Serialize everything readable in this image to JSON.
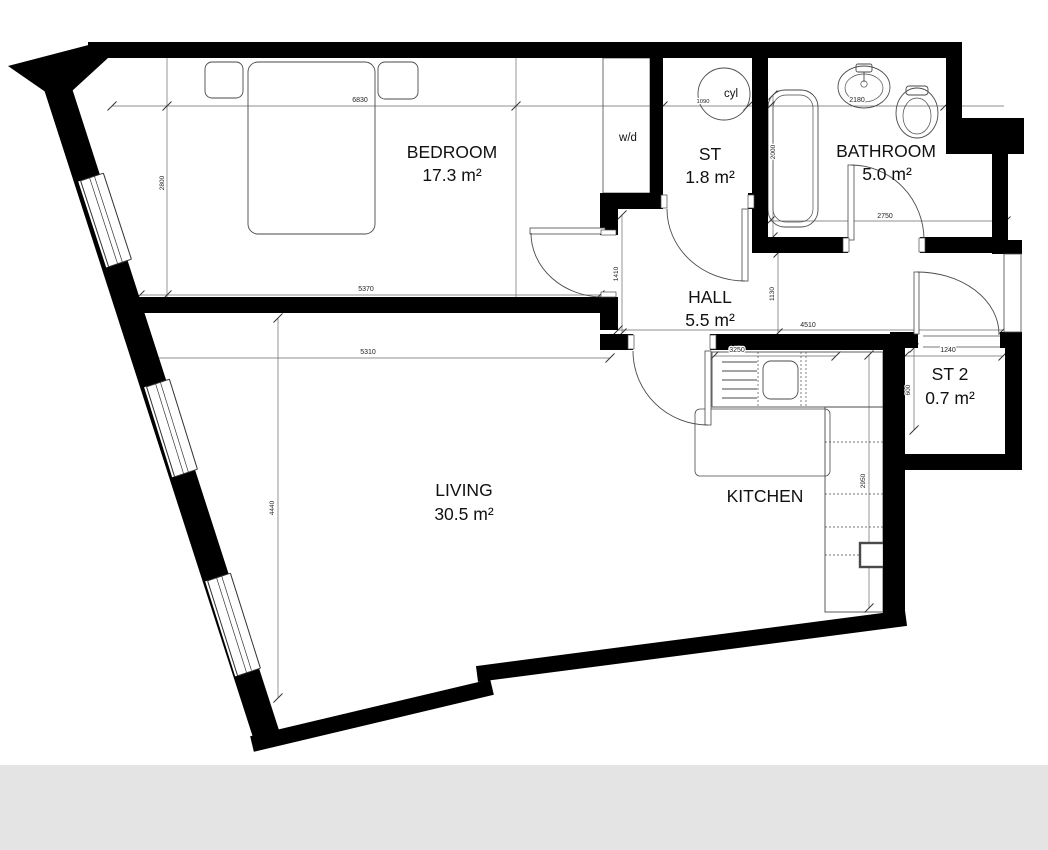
{
  "plan": {
    "title": "one-bedroom apartment floor plan",
    "rooms": {
      "bedroom": {
        "name": "BEDROOM",
        "area": "17.3 m²"
      },
      "st": {
        "name": "ST",
        "area": "1.8 m²"
      },
      "bathroom": {
        "name": "BATHROOM",
        "area": "5.0 m²"
      },
      "hall": {
        "name": "HALL",
        "area": "5.5 m²"
      },
      "st2": {
        "name": "ST 2",
        "area": "0.7 m²"
      },
      "living": {
        "name": "LIVING",
        "area": "30.5 m²"
      },
      "kitchen": {
        "name": "KITCHEN",
        "area": ""
      }
    },
    "fixtures": {
      "washer_dryer": "w/d",
      "cylinder": "cyl"
    },
    "dims": {
      "d6830": "6830",
      "d2800": "2800",
      "d5370": "5370",
      "d5310": "5310",
      "d4440": "4440",
      "d1410": "1410",
      "d1130": "1130",
      "d4510": "4510",
      "d3250": "3250",
      "d2950": "2950",
      "d1240": "1240",
      "d600": "600",
      "d2180": "2180",
      "d2000": "2000",
      "d2750": "2750",
      "d1090": "1090"
    },
    "colors": {
      "wall": "#000000",
      "thin_line": "#4a4a4a",
      "dim_line": "#6a6a6a",
      "footer_band": "#e4e4e4",
      "background": "#ffffff"
    }
  }
}
